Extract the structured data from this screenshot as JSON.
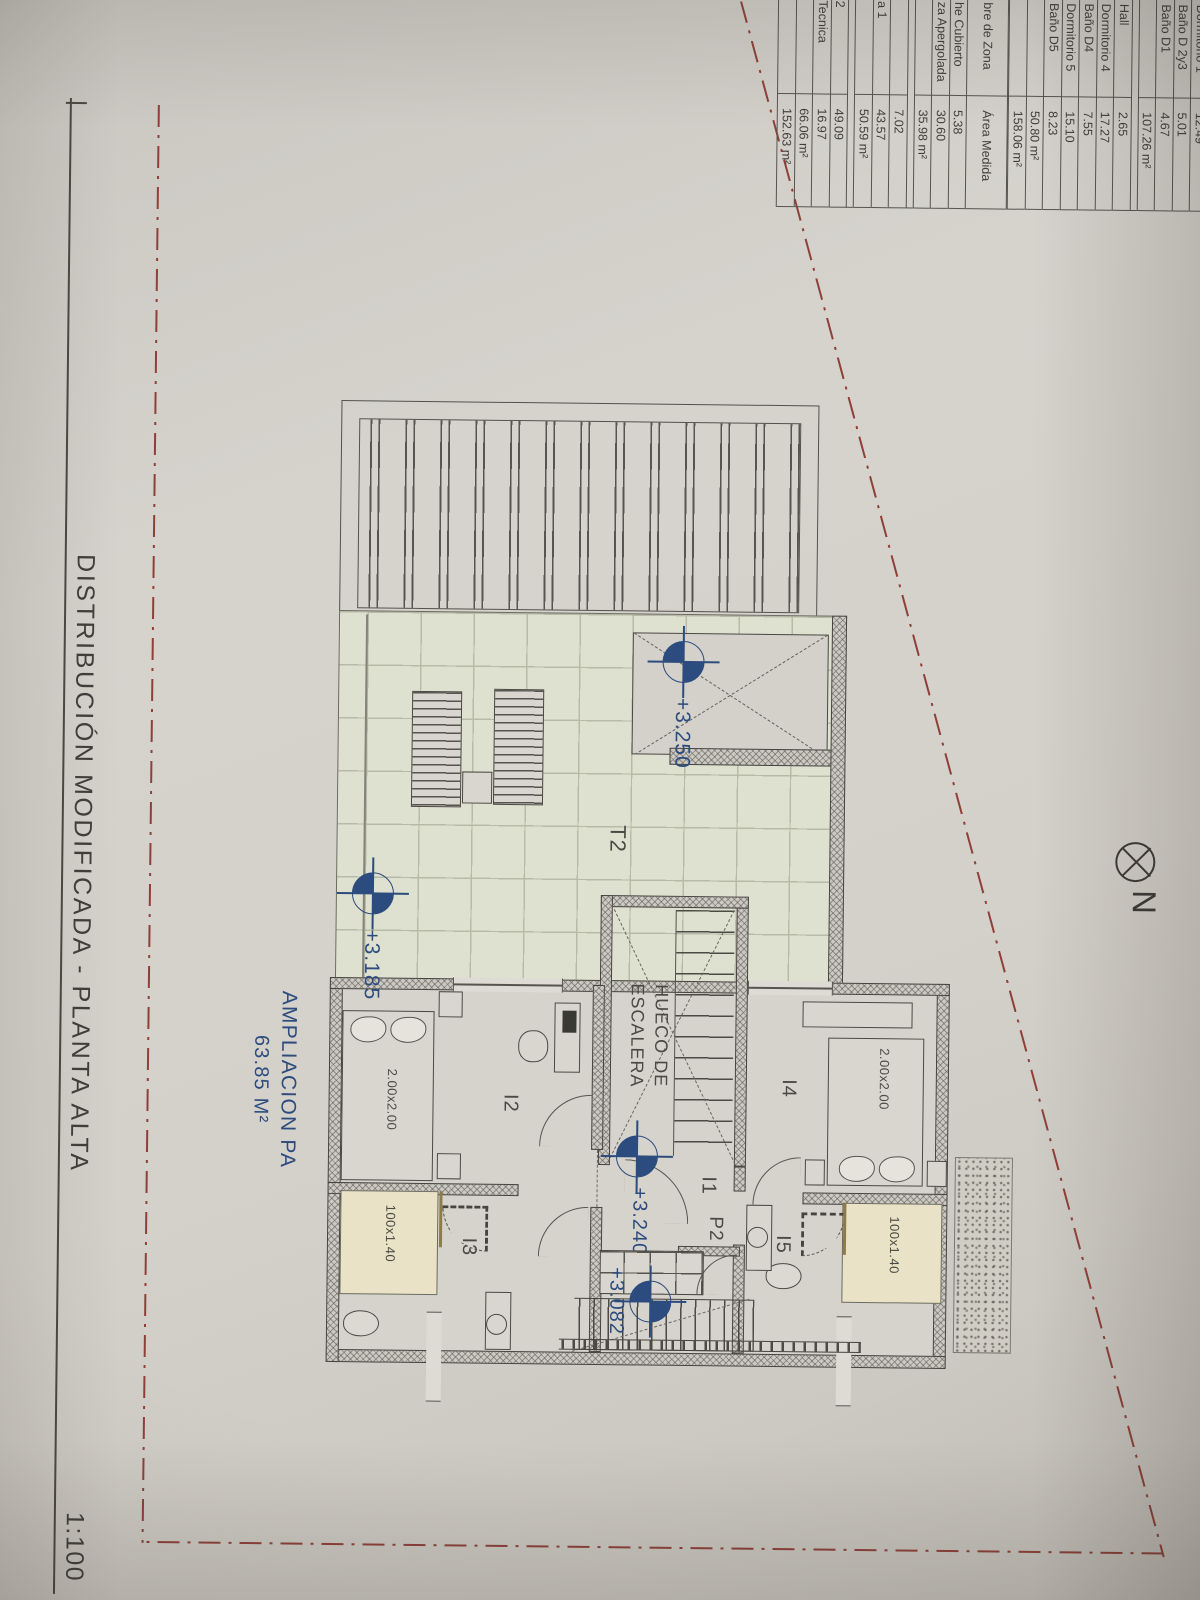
{
  "title_block": {
    "title": "DISTRIBUCIÓN MODIFICADA - PLANTA ALTA",
    "scale": "1:100"
  },
  "north": {
    "label": "N"
  },
  "area_table": {
    "header": {
      "name_col": "bre de Zona",
      "area_col": "Área Medida"
    },
    "top_sections": [
      {
        "rows": [
          [
            "Dormitorio 1",
            "12.49"
          ],
          [
            "Baño D 2y3",
            "5.01"
          ],
          [
            "Baño D1",
            "4.67"
          ],
          [
            "",
            "107.26 m²"
          ]
        ]
      },
      {
        "rows": [
          [
            "Hall",
            "2.65"
          ],
          [
            "Dormitorio 4",
            "17.27"
          ],
          [
            "Baño D4",
            "7.55"
          ],
          [
            "Dormitorio 5",
            "15.10"
          ],
          [
            "Baño D5",
            "8.23"
          ],
          [
            "",
            "50.80 m²"
          ],
          [
            "",
            "158.06 m²"
          ]
        ]
      }
    ],
    "bottom_sections": [
      {
        "rows": [
          [
            "he Cubierto",
            "5.38"
          ],
          [
            "za Apergolada",
            "30.60"
          ],
          [
            "",
            "35.98 m²"
          ]
        ]
      },
      {
        "rows": [
          [
            "",
            "7.02"
          ],
          [
            "a 1",
            "43.57"
          ],
          [
            "",
            "50.59 m²"
          ]
        ]
      },
      {
        "rows": [
          [
            "2",
            "49.09"
          ],
          [
            "Tecnica",
            "16.97"
          ],
          [
            "",
            "66.06 m²"
          ],
          [
            "",
            "152.63 m²"
          ]
        ]
      }
    ]
  },
  "plan": {
    "labels": {
      "terrace": "T2",
      "stair_line1": "HUECO DE",
      "stair_line2": "ESCALERA",
      "hall": "I1",
      "bedroom_left": "I2",
      "bath_left": "I3",
      "bedroom_right": "I4",
      "bath_right": "I5",
      "door": "P2",
      "bed_size": "2.00x2.00",
      "shower_size": "100x1.40"
    },
    "levels": {
      "terrace_upper": "+3.250",
      "terrace_lower": "+3.185",
      "hall": "+3.240",
      "stair_landing": "+3.082"
    },
    "extension": {
      "line1": "AMPLIACION PA",
      "line2": "63.85 M²"
    }
  },
  "colors": {
    "accent_blue": "#2c4b7e",
    "boundary_red": "#8e4038",
    "ink": "#45443f",
    "tile_green": "#dfe1d0",
    "shower_beige": "#e9e2c6",
    "paper": "#d2cfc8"
  }
}
